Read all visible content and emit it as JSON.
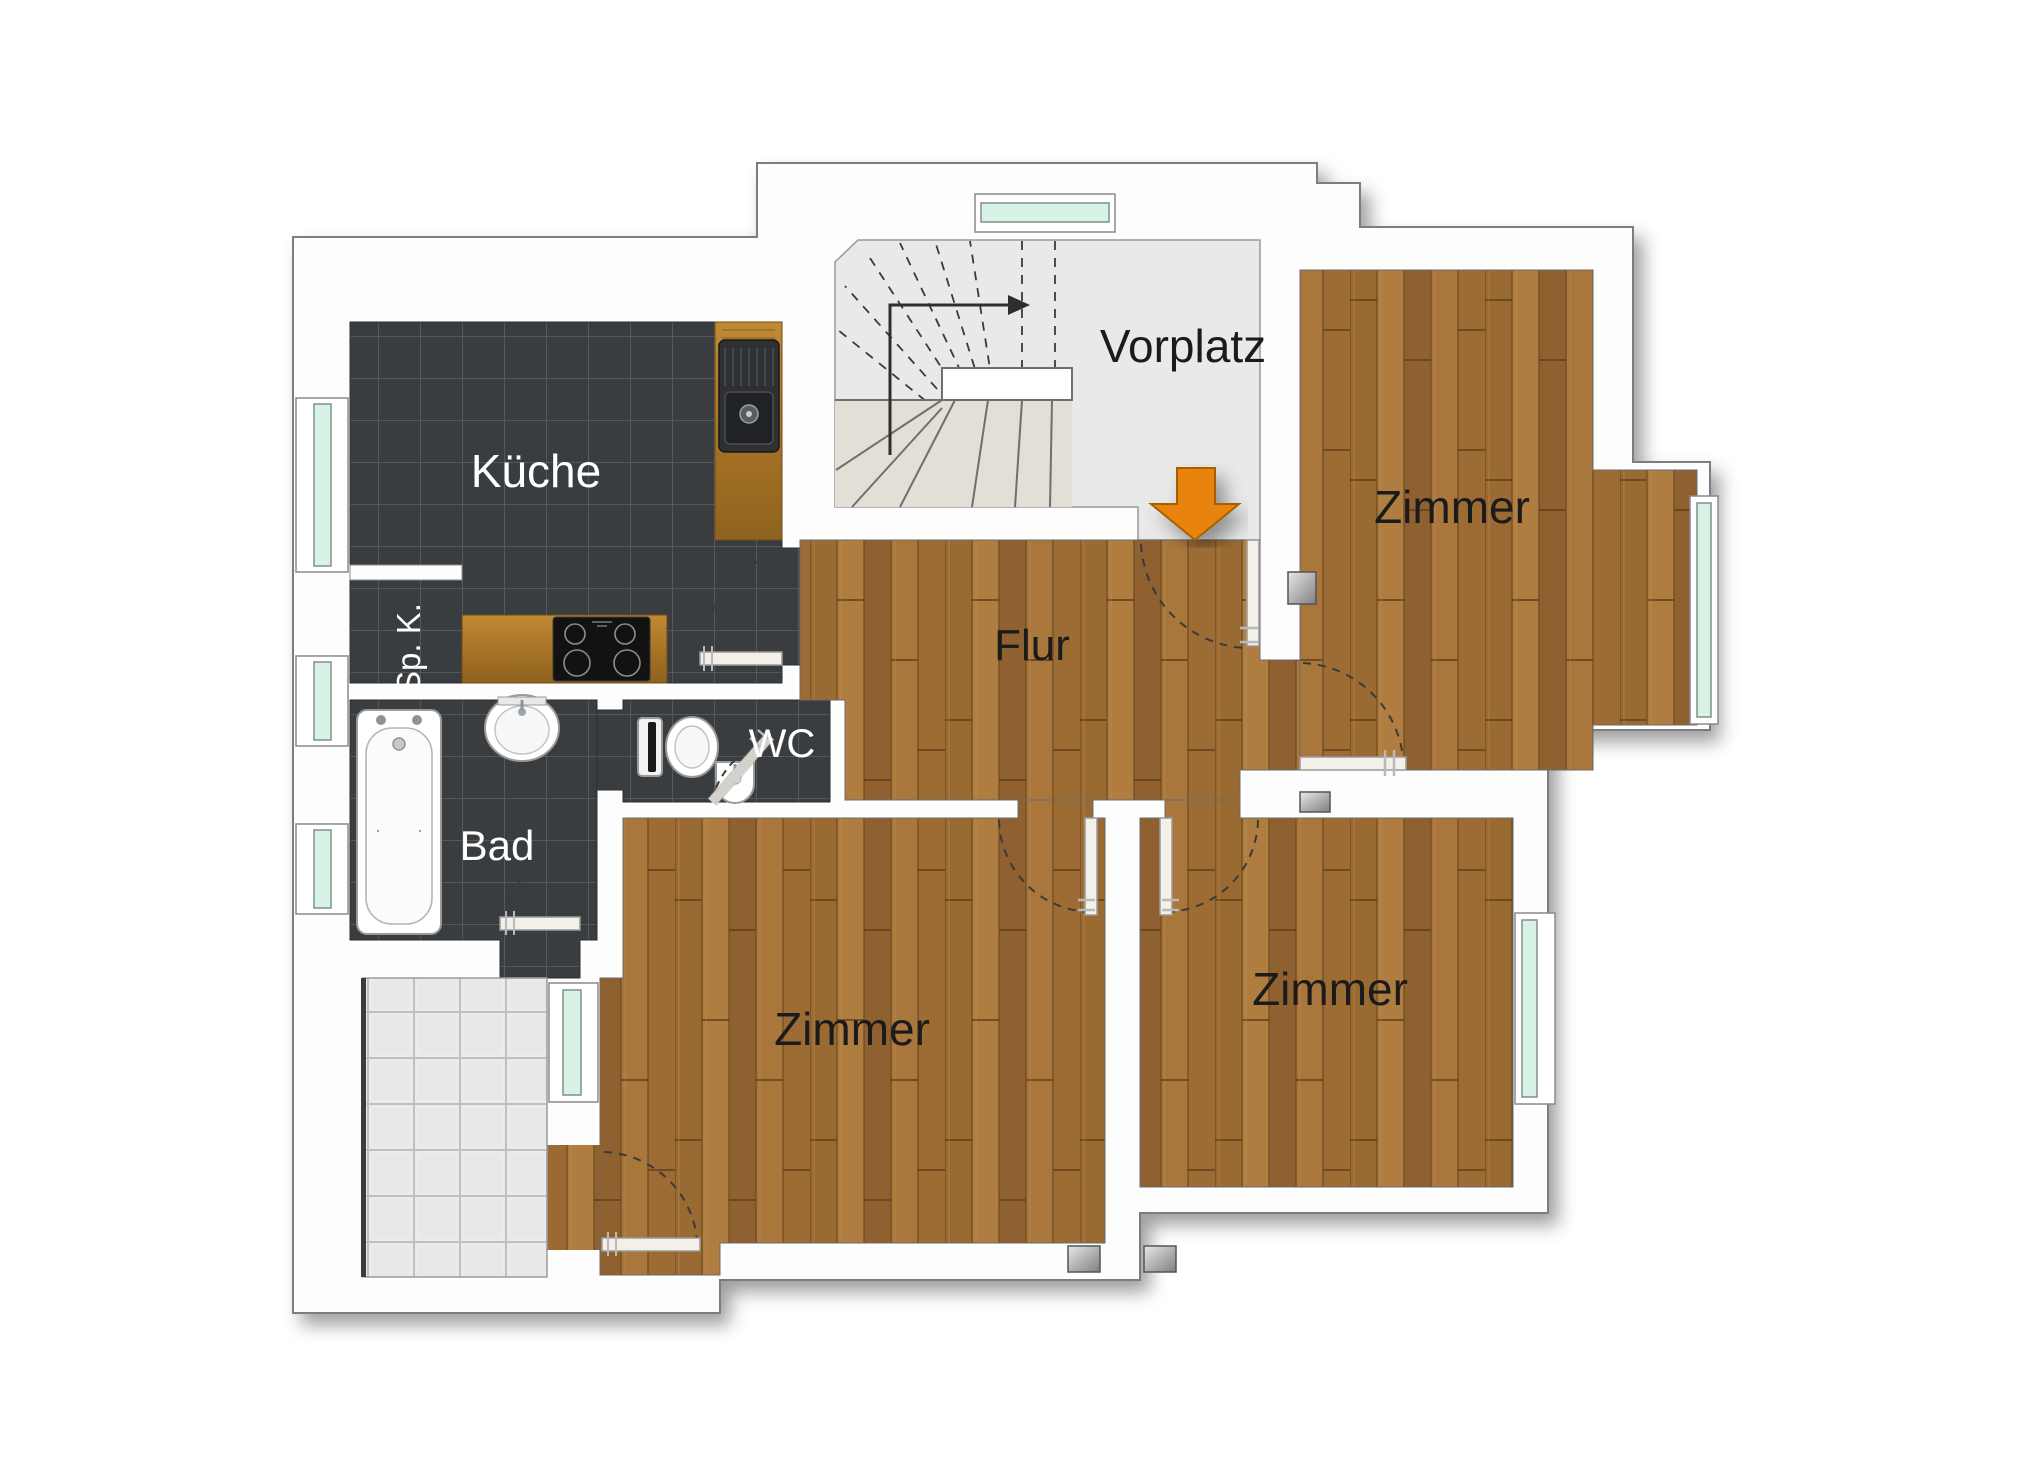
{
  "title": "Wohnung Grundriss (floor plan)",
  "rooms": {
    "kueche": "Küche",
    "sp_k": "Sp. K.",
    "bad": "Bad",
    "wc": "WC",
    "flur": "Flur",
    "vorplatz": "Vorplatz",
    "zimmer_top_right": "Zimmer",
    "zimmer_bottom_left": "Zimmer",
    "zimmer_bottom_right": "Zimmer"
  },
  "icons": {
    "entrance_arrow": "entrance-arrow-icon (orange, points into Flur)",
    "stair_direction_arrow": "stair-up-arrow-icon"
  },
  "fixtures": [
    "staircase",
    "kitchen-sink",
    "cooktop",
    "bathtub",
    "washbasin",
    "toilet",
    "wc-basin",
    "terrace-tiles",
    "wall-vents"
  ],
  "colors": {
    "wall_fill": "#fdfdfd",
    "wall_line": "#7d7d7d",
    "dark_tile": "#3a3d3f",
    "dark_tile_grout": "#5c6062",
    "parquet_base": "#a5archive",
    "parquet_main": "#a0703a",
    "parquet_line": "#5f3f16",
    "terrace_tile": "#ebebeb",
    "stair_floor": "#e9e9ea",
    "window_glass": "#d8f3e6",
    "accent_orange": "#e8830a",
    "door_leaf": "#f3efe9",
    "swing_arc": "#3a3a3a"
  }
}
